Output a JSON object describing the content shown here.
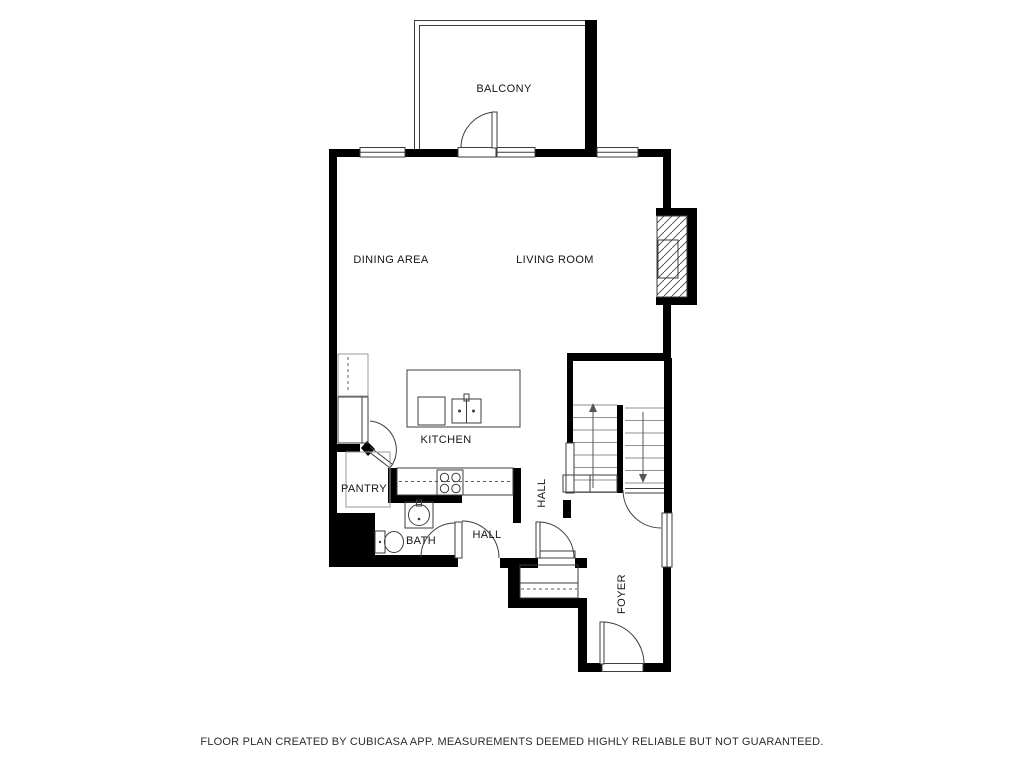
{
  "page": {
    "background": "#ffffff",
    "colors": {
      "wall": "#000000",
      "fixture_line": "#3d3d3d",
      "tread_line": "#8f8f8f",
      "text": "#161616"
    }
  },
  "plan": {
    "labels": {
      "balcony": "BALCONY",
      "dining_area": "DINING AREA",
      "living_room": "LIVING ROOM",
      "kitchen": "KITCHEN",
      "pantry": "PANTRY",
      "bath": "BATH",
      "hall_lower": "HALL",
      "hall_upper": "HALL",
      "foyer": "FOYER"
    },
    "icons": {
      "door-swing-icon": "quarter-circle arc with leaf",
      "window-icon": "white band with center line in wall",
      "stairs-up-arrow-icon": "line with triangular head pointing up",
      "stairs-down-arrow-icon": "line with triangular head pointing down",
      "fireplace-icon": "diagonal-hatched box on right wall",
      "kitchen-island-icon": "rectangle with double sink and cabinet",
      "cooktop-icon": "square with four burner circles",
      "refrigerator-icon": "rectangle with inner edge line",
      "dishwasher-icon": "rectangle with dashed center line",
      "sink-icon": "square with round basin and faucet",
      "toilet-icon": "tank rectangle with oval bowl",
      "closet-icon": "rectangle with shelf line and dashed rod line",
      "railing-icon": "thin open rectangle at stair side"
    }
  },
  "footer": {
    "disclaimer": "FLOOR PLAN CREATED BY CUBICASA APP. MEASUREMENTS DEEMED HIGHLY RELIABLE BUT NOT GUARANTEED."
  }
}
